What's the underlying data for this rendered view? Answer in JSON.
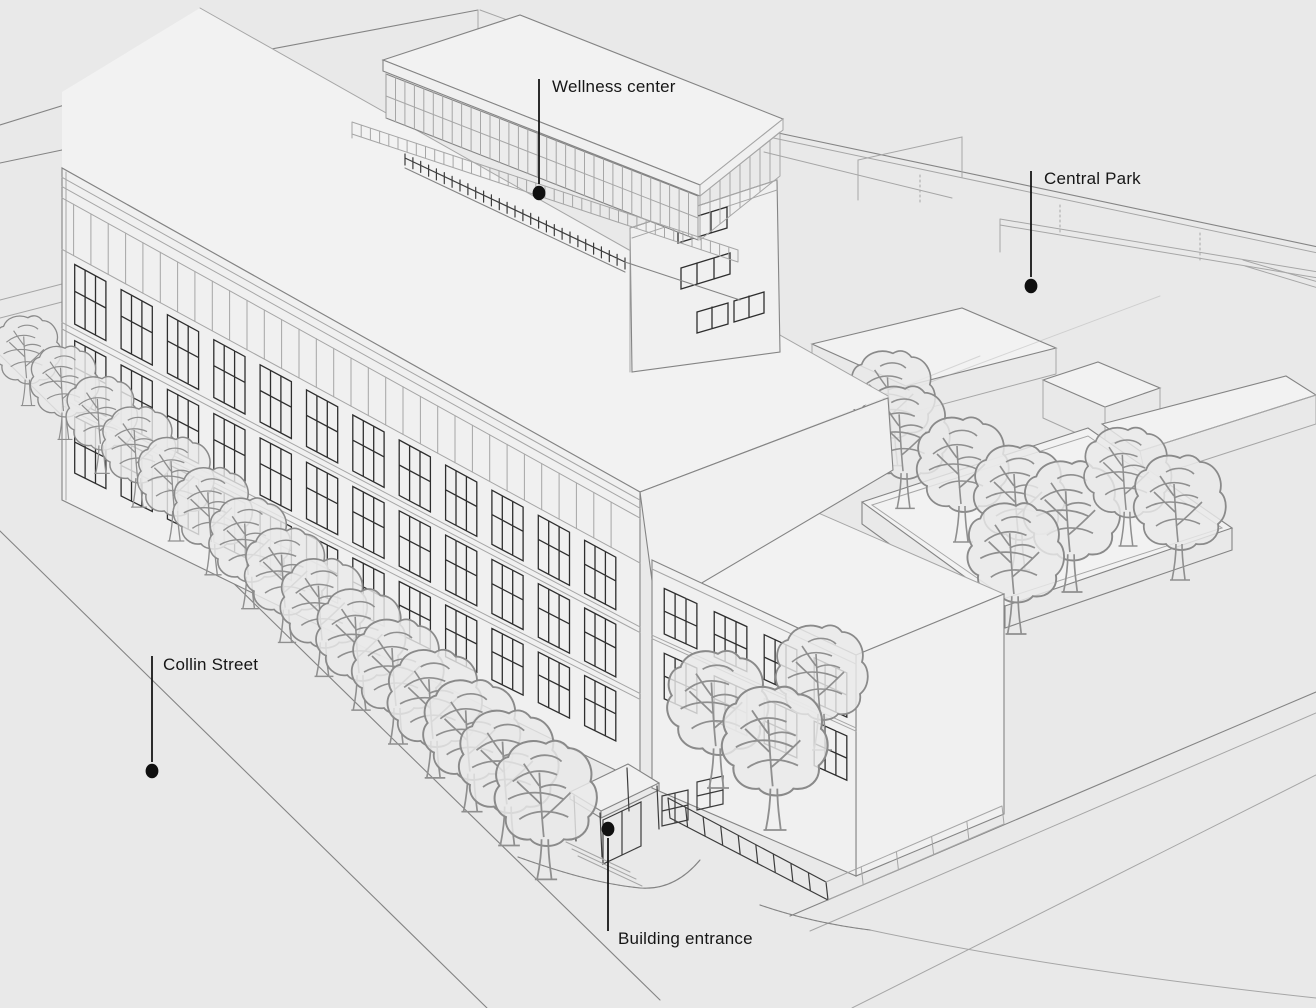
{
  "figure": {
    "kind": "architectural-axonometric-sketch",
    "description": "Wireframe perspective illustration of a multi-storey building with rooftop pavilion, street trees and adjacent park"
  },
  "colors": {
    "background": "#e9e9e9",
    "ink": "#161616",
    "sketch_light": "#a6a6a6",
    "sketch_medium": "#848484",
    "sketch_dark": "#3c3c3c"
  },
  "annotations": [
    {
      "id": "wellness-center",
      "label": "Wellness center",
      "dot": {
        "x": 539,
        "y": 193
      },
      "line": {
        "y1": 79,
        "y2": 184
      },
      "text": {
        "x": 552,
        "y": 92
      }
    },
    {
      "id": "central-park",
      "label": "Central Park",
      "dot": {
        "x": 1031,
        "y": 286
      },
      "line": {
        "y1": 171,
        "y2": 277
      },
      "text": {
        "x": 1044,
        "y": 184
      }
    },
    {
      "id": "collin-street",
      "label": "Collin Street",
      "dot": {
        "x": 152,
        "y": 771
      },
      "line": {
        "y1": 656,
        "y2": 762
      },
      "text": {
        "x": 163,
        "y": 670
      }
    },
    {
      "id": "building-entrance",
      "label": "Building entrance",
      "dot": {
        "x": 608,
        "y": 829
      },
      "line": {
        "y1": 838,
        "y2": 931
      },
      "text": {
        "x": 618,
        "y": 944
      }
    }
  ]
}
